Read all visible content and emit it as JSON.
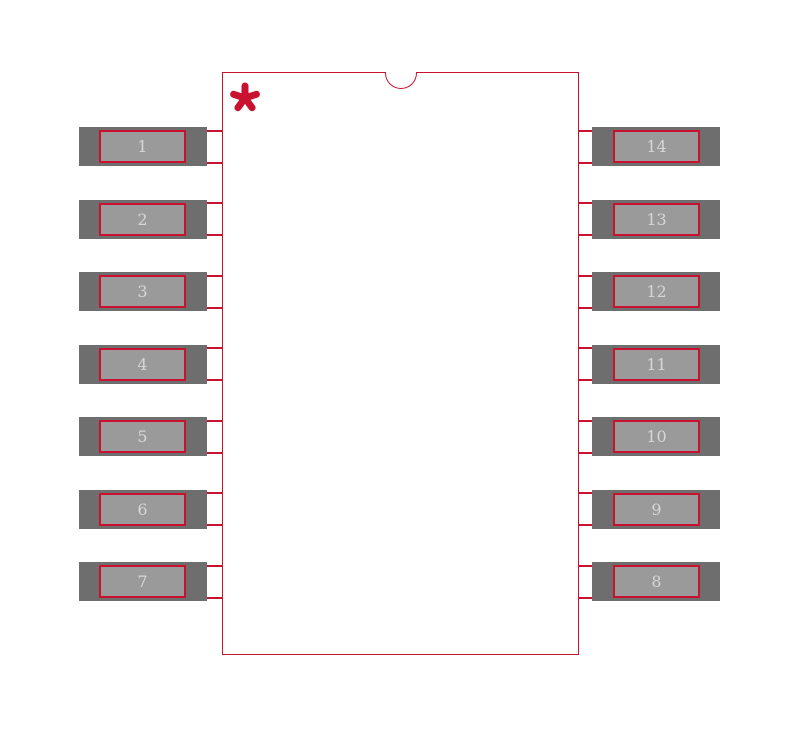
{
  "canvas": {
    "width": 800,
    "height": 729,
    "background": "#ffffff"
  },
  "colors": {
    "outline_red": "#c9122f",
    "pad_end_gray": "#6e6e6e",
    "pad_inner_gray": "#9a9a9a",
    "pad_number_text": "#d6d6d6"
  },
  "footprint": {
    "pad_count": 14,
    "left_pad_numbers": [
      "1",
      "2",
      "3",
      "4",
      "5",
      "6",
      "7"
    ],
    "right_pad_numbers": [
      "14",
      "13",
      "12",
      "11",
      "10",
      "9",
      "8"
    ],
    "pin1_marker": "asterisk",
    "notch": "top-center semicircle"
  }
}
